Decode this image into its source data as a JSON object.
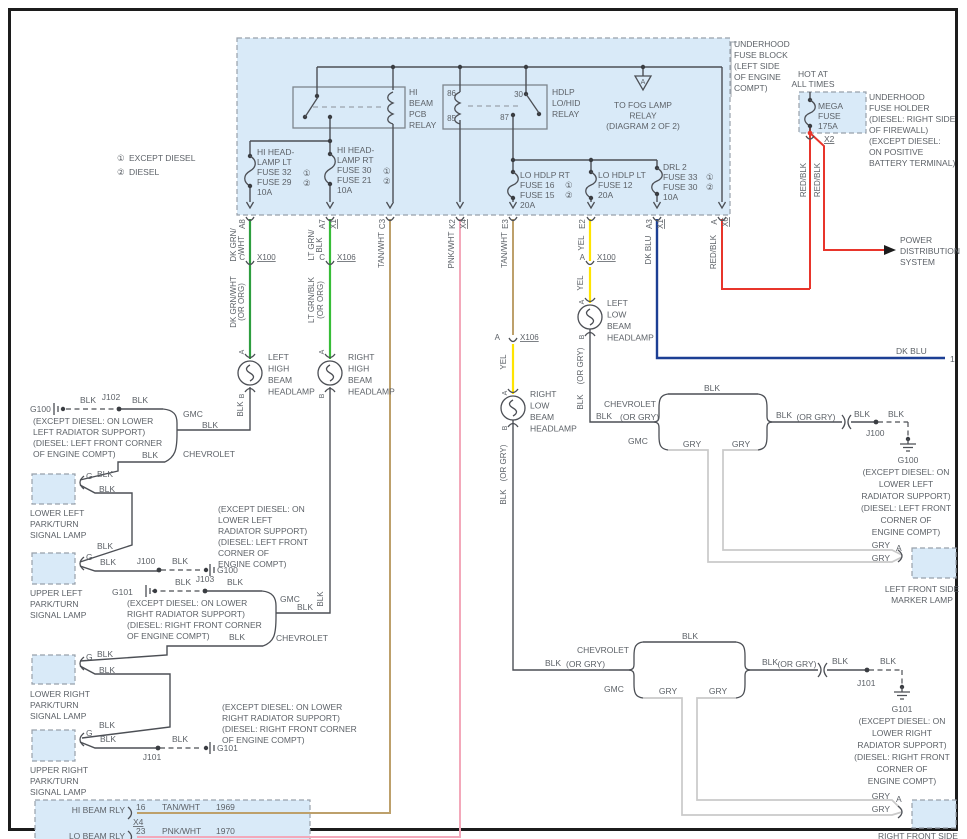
{
  "colors": {
    "green_dk": "#2e9e3f",
    "green_lt": "#37bd37",
    "tan": "#bda06b",
    "pink": "#f3a8ba",
    "yellow": "#ffe400",
    "blue": "#1c3f94",
    "red": "#e8352b",
    "black": "#4c4f55",
    "gray": "#c9c9c9",
    "panel": "#d9eaf8"
  },
  "legend": {
    "n1": "①",
    "l1": "EXCEPT DIESEL",
    "n2": "②",
    "l2": "DIESEL"
  },
  "block": {
    "title": [
      "UNDERHOOD",
      "FUSE BLOCK",
      "(LEFT SIDE",
      "OF ENGINE",
      "COMPT)"
    ],
    "relay1": [
      "HI",
      "BEAM",
      "PCB",
      "RELAY"
    ],
    "relay2": [
      "HDLP",
      "LO/HID",
      "RELAY"
    ],
    "t86": "86",
    "t85": "85",
    "t30": "30",
    "t87": "87",
    "fog_a": "A",
    "fog": [
      "TO FOG LAMP",
      "RELAY",
      "(DIAGRAM 2 OF 2)"
    ],
    "f_hi_lt": [
      "HI HEAD-",
      "LAMP LT",
      "FUSE 32",
      "FUSE 29",
      "10A"
    ],
    "f_hi_rt": [
      "HI HEAD-",
      "LAMP RT",
      "FUSE 30",
      "FUSE 21",
      "10A"
    ],
    "f_lo_rt": [
      "LO HDLP RT",
      "FUSE 16",
      "FUSE 15",
      "20A"
    ],
    "f_lo_lt": [
      "LO HDLP LT",
      "FUSE 12",
      "20A"
    ],
    "f_drl": [
      "DRL 2",
      "FUSE 33",
      "FUSE 30",
      "10A"
    ],
    "c1": "①",
    "c2": "②"
  },
  "holder": {
    "hot1": "HOT AT",
    "hot2": "ALL TIMES",
    "mega": [
      "MEGA",
      "FUSE",
      "175A"
    ],
    "x2": "X2",
    "title": [
      "UNDERHOOD",
      "FUSE HOLDER",
      "(DIESEL: RIGHT SIDE",
      "OF FIREWALL)",
      "(EXCEPT DIESEL:",
      "ON POSITIVE",
      "BATTERY TERMINAL)"
    ],
    "power": [
      "POWER",
      "DISTRIBUTION",
      "SYSTEM"
    ]
  },
  "term": {
    "a8": "A8",
    "a7": "A7",
    "x1": "X1",
    "c3": "C3",
    "k2": "K2",
    "x4": "X4",
    "e3": "E3",
    "e2": "E2",
    "a3": "A3",
    "a": "A",
    "b": "B",
    "c": "C",
    "g": "G",
    "x6": "X6",
    "x100": "X100",
    "x106": "X106"
  },
  "wire": {
    "dkgrn1": "DK GRN/",
    "wht": "WHT",
    "ltgrn1": "LT GRN/",
    "blk": "BLK",
    "dkgrnwht": "DK GRN/WHT",
    "ltgrnblk": "LT GRN/BLK",
    "ororg": "(OR ORG)",
    "orgry": "(OR GRY)",
    "tanwht": "TAN/WHT",
    "pnkwht": "PNK/WHT",
    "yel": "YEL",
    "dkblu": "DK BLU",
    "redblk": "RED/BLK",
    "gry": "GRY",
    "one": "1"
  },
  "makes": {
    "gmc": "GMC",
    "chev": "CHEVROLET"
  },
  "lamp": {
    "lh": [
      "LEFT",
      "HIGH",
      "BEAM",
      "HEADLAMP"
    ],
    "rh": [
      "RIGHT",
      "HIGH",
      "BEAM",
      "HEADLAMP"
    ],
    "ll": [
      "LEFT",
      "LOW",
      "BEAM",
      "HEADLAMP"
    ],
    "rl": [
      "RIGHT",
      "LOW",
      "BEAM",
      "HEADLAMP"
    ],
    "lowleft": [
      "LOWER LEFT",
      "PARK/TURN",
      "SIGNAL LAMP"
    ],
    "upleft": [
      "UPPER LEFT",
      "PARK/TURN",
      "SIGNAL LAMP"
    ],
    "lowright": [
      "LOWER RIGHT",
      "PARK/TURN",
      "SIGNAL LAMP"
    ],
    "upright": [
      "UPPER RIGHT",
      "PARK/TURN",
      "SIGNAL LAMP"
    ],
    "lmark": [
      "LEFT FRONT SIDE",
      "MARKER LAMP"
    ],
    "rmark": [
      "RIGHT FRONT SIDE"
    ]
  },
  "gnd": {
    "g100": "G100",
    "g101": "G101",
    "j100": "J100",
    "j101": "J101",
    "j102": "J102",
    "j103": "J103",
    "noteA": [
      "(EXCEPT DIESEL: ON LOWER",
      "LEFT RADIATOR SUPPORT)",
      "(DIESEL: LEFT FRONT CORNER",
      "OF ENGINE COMPT)"
    ],
    "noteB": [
      "(EXCEPT DIESEL: ON LOWER",
      "RIGHT RADIATOR SUPPORT)",
      "(DIESEL: RIGHT FRONT CORNER",
      "OF ENGINE COMPT)"
    ],
    "noteC": [
      "(EXCEPT DIESEL: ON",
      "LOWER LEFT",
      "RADIATOR SUPPORT)",
      "(DIESEL: LEFT FRONT",
      "CORNER OF",
      "ENGINE COMPT)"
    ],
    "noteD": [
      "(EXCEPT DIESEL: ON",
      "LOWER RIGHT",
      "RADIATOR SUPPORT)",
      "(DIESEL: RIGHT FRONT",
      "CORNER OF",
      "ENGINE COMPT)"
    ]
  },
  "ip": {
    "hi": "HI BEAM RLY",
    "lo": "LO BEAM RLY",
    "p16": "16",
    "p23": "23",
    "x4": "X4",
    "w1": "TAN/WHT",
    "w2": "PNK/WHT",
    "c1": "1969",
    "c2": "1970"
  }
}
